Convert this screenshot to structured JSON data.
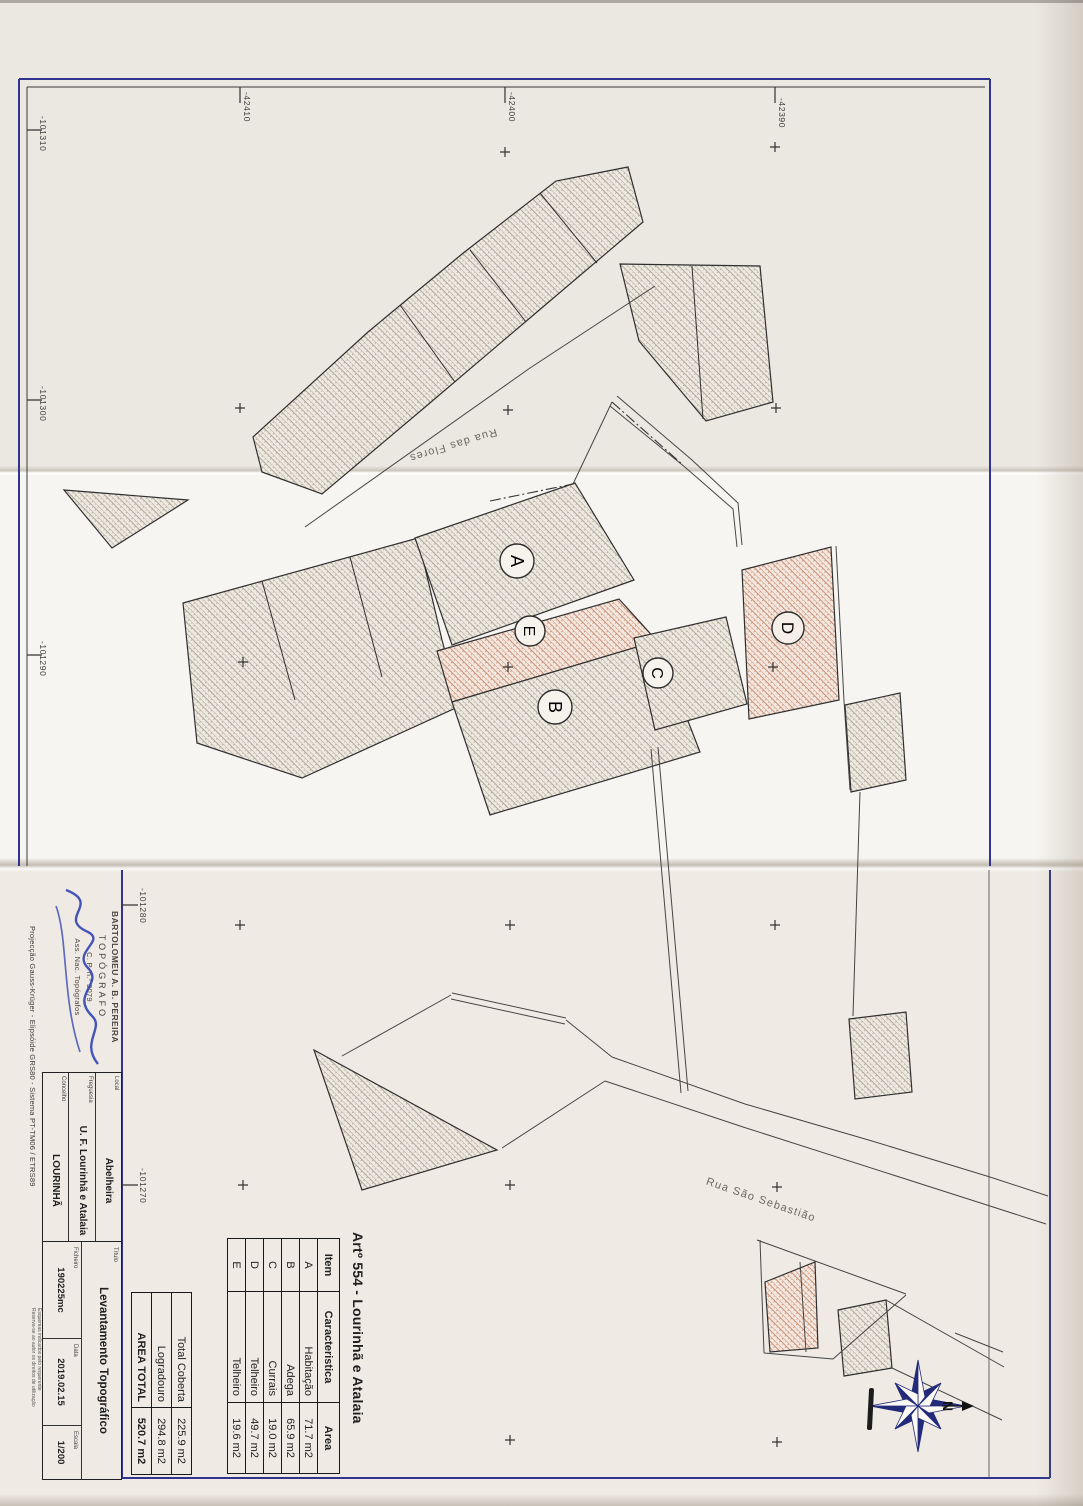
{
  "plan": {
    "streets": {
      "rua_das_flores": "Rua das Flores",
      "rua_sao_sebastiao": "Rua São Sebastião"
    },
    "building_labels": {
      "a": "A",
      "b": "B",
      "c": "C",
      "d": "D",
      "e": "E"
    },
    "grid_labels": {
      "top": [
        "-42410",
        "-42400",
        "-42390"
      ],
      "left": [
        "-101310",
        "-101300",
        "-101290"
      ],
      "lower_left": [
        "-101280",
        "-101270"
      ]
    },
    "compass_north": "N"
  },
  "area_table": {
    "title": "Artº 554 - Lourinhã e Atalaia",
    "headers": {
      "item": "Item",
      "name": "Caracteristica",
      "area": "Area"
    },
    "rows": [
      {
        "item": "A",
        "name": "Habitação",
        "area": "71.7 m2"
      },
      {
        "item": "B",
        "name": "Adega",
        "area": "65.9 m2"
      },
      {
        "item": "C",
        "name": "Currais",
        "area": "19.0 m2"
      },
      {
        "item": "D",
        "name": "Telheiro",
        "area": "49.7 m2"
      },
      {
        "item": "E",
        "name": "Telheiro",
        "area": "19.6 m2"
      }
    ],
    "totals": [
      {
        "label": "Total Coberta",
        "value": "225.9 m2"
      },
      {
        "label": "Logradouro",
        "value": "294.8 m2"
      },
      {
        "label": "AREA TOTAL",
        "value": "520.7 m2"
      }
    ]
  },
  "title_block": {
    "stamp": {
      "line1": "BARTOLOMEU A. B. PEREIRA",
      "line2": "TOPÓGRAFO",
      "line3": "C. P. n.º 3079",
      "line4": "Ass. Nac. Topógrafos"
    },
    "fields": {
      "local_label": "Local",
      "local_value": "Abelheira",
      "freguesia_label": "Freguesia",
      "freguesia_value": "U. F. Lourinhã e Atalaia",
      "concelho_label": "Concelho",
      "concelho_value": "LOURINHÃ",
      "titulo_label": "Título",
      "titulo_value": "Levantamento Topográfico",
      "ficheiro_label": "Ficheiro",
      "ficheiro_value": "190225mc",
      "data_label": "Data",
      "data_value": "2019.02.15",
      "escala_label": "Escala",
      "escala_value": "1/200"
    },
    "notes": {
      "line1": "Esquemas indicados pelo requerente",
      "line2": "Reserva-se ao autor os direitos de utilização"
    },
    "projection": "Projecção Gauss-Krüger - Elipsóide GRS80 - Sistema PT-TM06 / ETRS89"
  }
}
